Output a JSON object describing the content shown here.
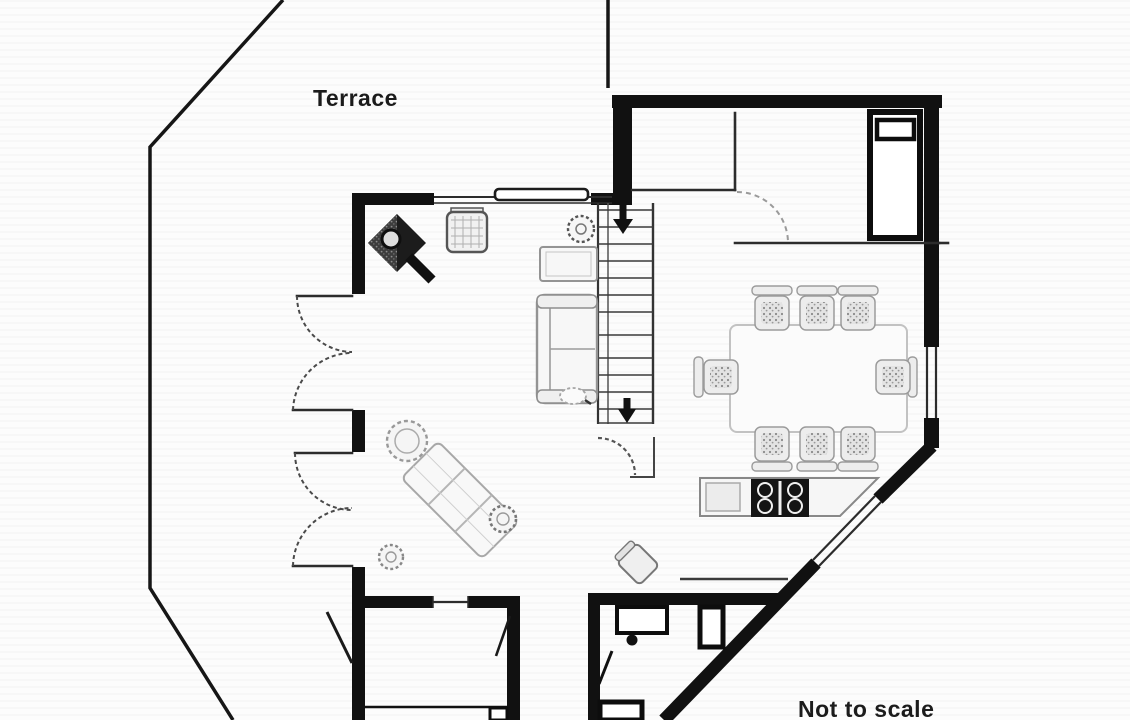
{
  "labels": {
    "terrace": "Terrace",
    "scale_note": "Not to scale"
  },
  "colors": {
    "wall": "#111111",
    "thin_line": "#2c2c2c",
    "furniture_outline": "#949494",
    "table_outline": "#c2c2c2",
    "background": "#fcfcfc"
  },
  "plan": {
    "type": "floor-plan",
    "icons": {
      "wood-stove": "black diamond with circle",
      "wicker-chair": "hatched square",
      "sofa": "outlined rect with cushions",
      "side-table": "outlined rect",
      "plant": "scalloped circle",
      "staircase": "treads with down arrows",
      "french-doors": "double swing arcs",
      "bed": "thick outlined rect with pillow",
      "dining-table": "light rounded rect",
      "dining-chair": "speckled square",
      "kitchen-cooktop": "black rect with four burners",
      "kitchen-sink": "grey square",
      "lounger": "rotated slatted rect with round head",
      "stool": "scalloped small circle",
      "washbasin": "outlined rect with tap dot",
      "toilet-unit": "small outlined rect",
      "window": "double thin lines in wall gap"
    }
  }
}
